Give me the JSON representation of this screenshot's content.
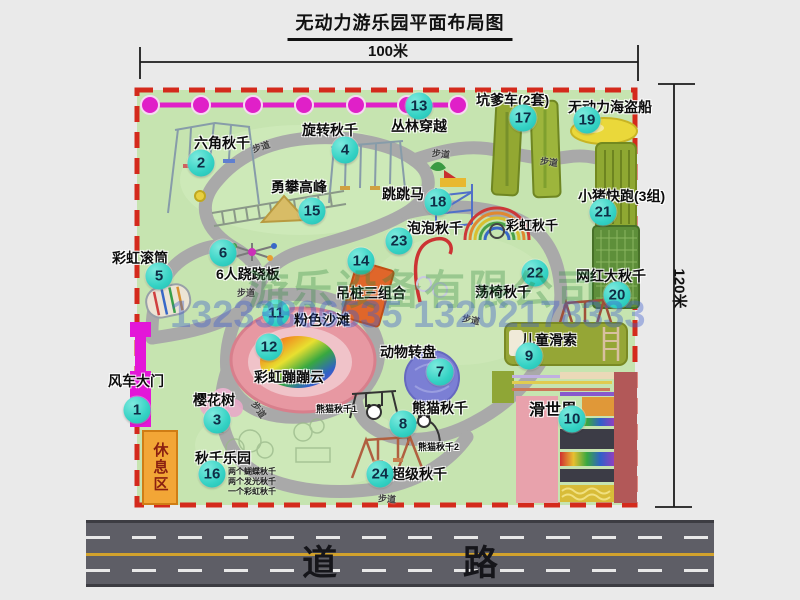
{
  "title": "无动力游乐园平面布局图",
  "measurements": {
    "width": "100米",
    "height": "120米"
  },
  "road_label": "道 路",
  "path_label": "步道",
  "rest_area_label": "休息区",
  "watermark": {
    "company": "游乐设备有限公司",
    "phone": "13233806535 13202178333"
  },
  "extra_labels": {
    "rainbow_swing": "彩虹秋千",
    "panda_swing_1": "熊猫秋千1",
    "panda_swing_2": "熊猫秋千2"
  },
  "attractions": [
    {
      "num": 1,
      "name": "风车大门"
    },
    {
      "num": 2,
      "name": "六角秋千"
    },
    {
      "num": 3,
      "name": "樱花树"
    },
    {
      "num": 4,
      "name": "旋转秋千"
    },
    {
      "num": 5,
      "name": "彩虹滚筒"
    },
    {
      "num": 6,
      "name": "6人跷跷板"
    },
    {
      "num": 7,
      "name": "动物转盘"
    },
    {
      "num": 8,
      "name": "熊猫秋千"
    },
    {
      "num": 9,
      "name": "儿童滑索"
    },
    {
      "num": 10,
      "name": "滑世界"
    },
    {
      "num": 11,
      "name": "粉色沙滩"
    },
    {
      "num": 12,
      "name": "彩虹蹦蹦云"
    },
    {
      "num": 13,
      "name": "丛林穿越"
    },
    {
      "num": 14,
      "name": "吊桩三组合"
    },
    {
      "num": 15,
      "name": "勇攀高峰"
    },
    {
      "num": 16,
      "name": "秋千乐园",
      "notes": [
        "两个蝴蝶秋千",
        "两个发光秋千",
        "一个彩虹秋千"
      ]
    },
    {
      "num": 17,
      "name": "坑爹车(2套)"
    },
    {
      "num": 18,
      "name": "跳跳马"
    },
    {
      "num": 19,
      "name": "无动力海盗船"
    },
    {
      "num": 20,
      "name": "网红大秋千"
    },
    {
      "num": 21,
      "name": "小猪快跑(3组)"
    },
    {
      "num": 22,
      "name": "荡椅秋千"
    },
    {
      "num": 23,
      "name": "泡泡秋千"
    },
    {
      "num": 24,
      "name": "超级秋千"
    }
  ],
  "colors": {
    "park_green": "#c6e4b0",
    "boundary_red": "#d42a1c",
    "badge_teal": "#34d2c4",
    "gate_magenta": "#e317d8",
    "zipline_magenta": "#e020c8",
    "road_gray": "#5e5e66",
    "rest_area_orange": "#f2a636"
  }
}
